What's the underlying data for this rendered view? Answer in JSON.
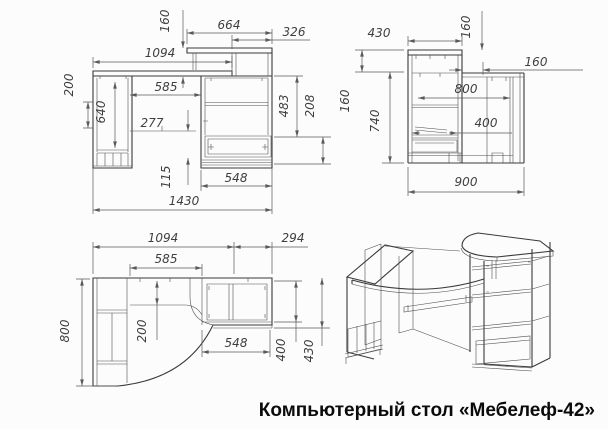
{
  "title": "Компьютерный стол «Мебелеф-42»",
  "dims": {
    "front": {
      "d664": "664",
      "d326": "326",
      "d1094": "1094",
      "d160": "160",
      "d200": "200",
      "d640": "640",
      "d585": "585",
      "d277": "277",
      "d115": "115",
      "d483": "483",
      "d208": "208",
      "d548": "548",
      "d1430": "1430"
    },
    "side": {
      "d430": "430",
      "d160_top": "160",
      "d160_right": "160",
      "d160_left": "160",
      "d740": "740",
      "d800": "800",
      "d400": "400",
      "d900": "900"
    },
    "top": {
      "d1094": "1094",
      "d294": "294",
      "d585": "585",
      "d800": "800",
      "d200": "200",
      "d548": "548",
      "d400": "400",
      "d430": "430"
    }
  }
}
